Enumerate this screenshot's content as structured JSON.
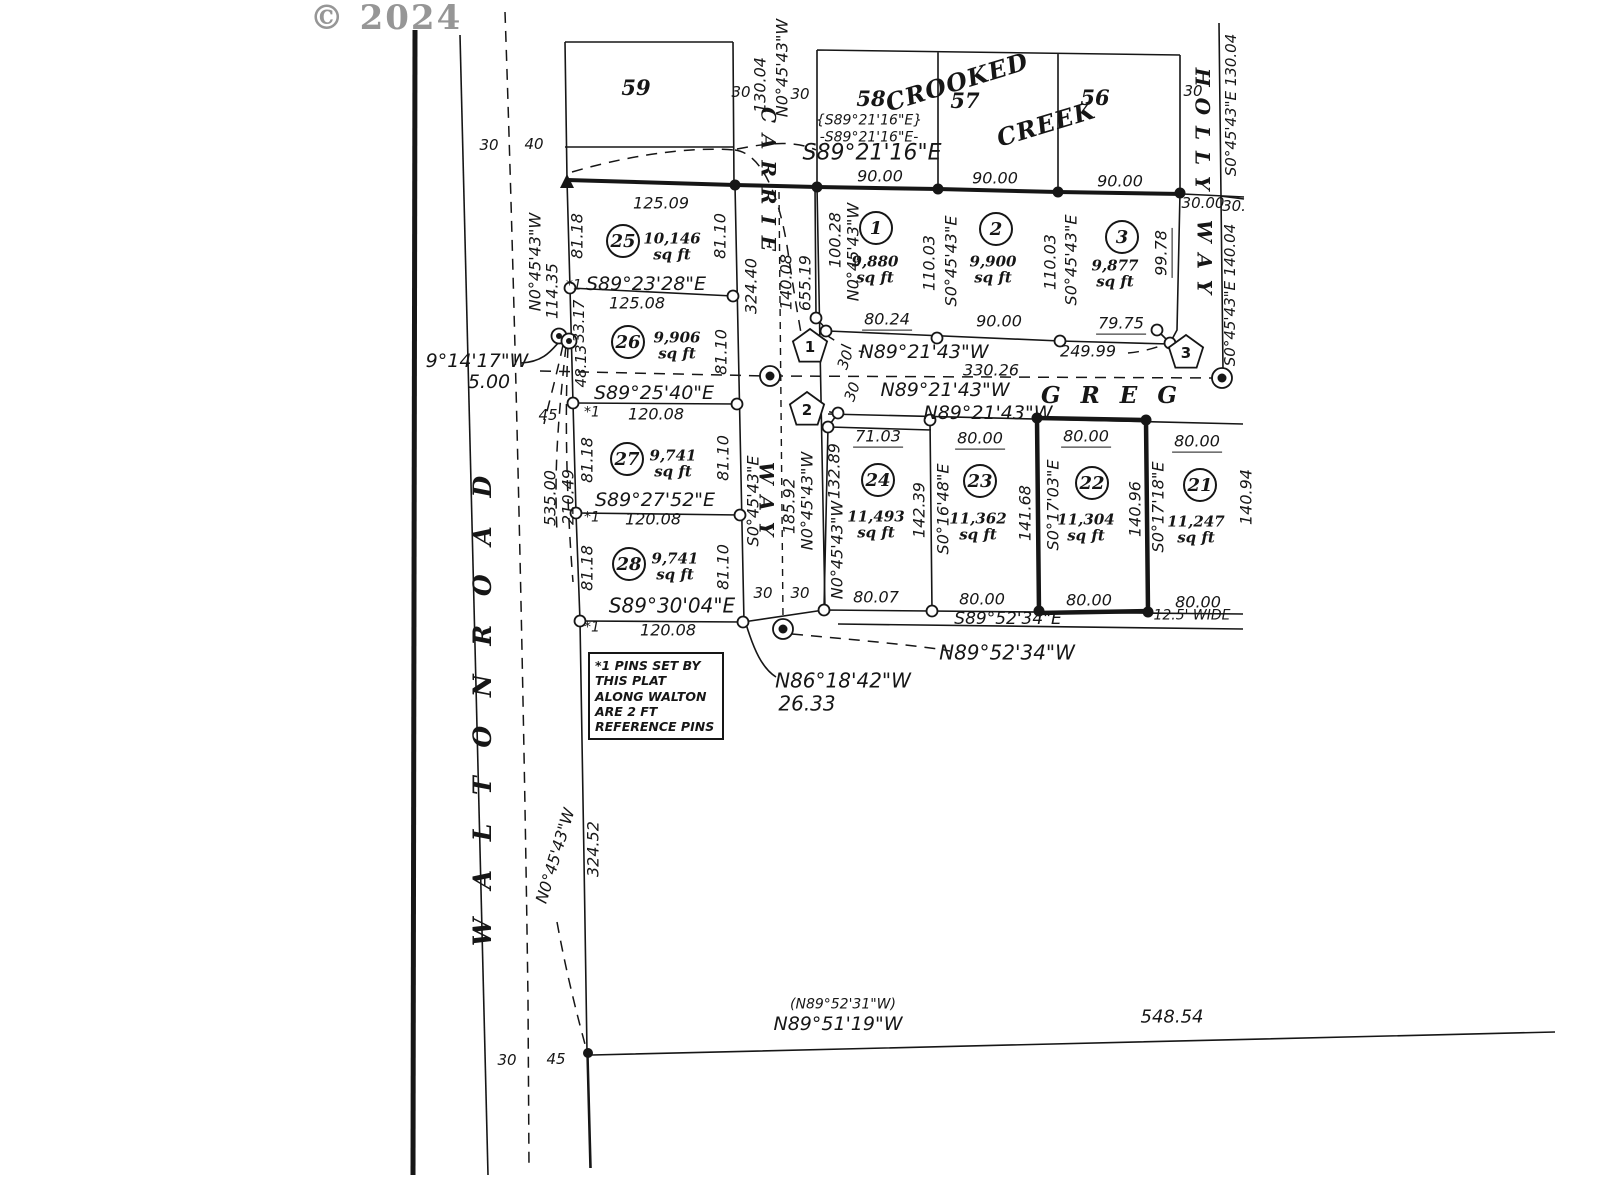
{
  "watermark": "© 2024",
  "colors": {
    "ink": "#161616",
    "background": "#ffffff",
    "watermark_gray": "#969696"
  },
  "note_box": {
    "lines": [
      "*1 PINS SET BY",
      "THIS PLAT",
      "ALONG WALTON",
      "ARE 2 FT",
      "REFERENCE PINS"
    ]
  },
  "streets": {
    "walton_road": "WALTON ROAD",
    "carrie_way": "CARRIE WAY",
    "greg": "GREG",
    "holly_way": "HOLLY WAY",
    "creek": "CROOKED CREEK"
  },
  "lots": [
    {
      "number": "1",
      "area": "9,880 sq ft"
    },
    {
      "number": "2",
      "area": "9,900 sq ft"
    },
    {
      "number": "3",
      "area": "9,877 sq ft"
    },
    {
      "number": "21",
      "area": "11,247 sq ft"
    },
    {
      "number": "22",
      "area": "11,304 sq ft",
      "highlighted": true
    },
    {
      "number": "23",
      "area": "11,362 sq ft"
    },
    {
      "number": "24",
      "area": "11,493 sq ft"
    },
    {
      "number": "25",
      "area": "10,146 sq ft"
    },
    {
      "number": "26",
      "area": "9,906 sq ft"
    },
    {
      "number": "27",
      "area": "9,741 sq ft"
    },
    {
      "number": "28",
      "area": "9,741 sq ft"
    }
  ],
  "adjacent_lots": [
    "59",
    "58",
    "57",
    "56"
  ],
  "labels": [
    {
      "n": "copyright-watermark",
      "t": "© 2024",
      "x": 386,
      "y": 19,
      "c": "wm"
    },
    {
      "t": "30",
      "x": 489,
      "y": 146,
      "c": "sm"
    },
    {
      "t": "40",
      "x": 534,
      "y": 145,
      "c": "sm"
    },
    {
      "n": "lot-59-number",
      "t": "59",
      "x": 636,
      "y": 88,
      "c": "adj"
    },
    {
      "n": "lot-58-number",
      "t": "58",
      "x": 871,
      "y": 99,
      "c": "adj"
    },
    {
      "n": "lot-57-number",
      "t": "57",
      "x": 965,
      "y": 101,
      "c": "adj"
    },
    {
      "n": "lot-56-number",
      "t": "56",
      "x": 1095,
      "y": 98,
      "c": "adj"
    },
    {
      "n": "creek-name-crooked",
      "t": "CROOKED",
      "x": 957,
      "y": 82,
      "r": -17,
      "c": "creek"
    },
    {
      "n": "creek-name-creek",
      "t": "CREEK",
      "x": 1046,
      "y": 124,
      "r": -17,
      "c": "creek"
    },
    {
      "t": "{S89°21'16\"E}",
      "x": 869,
      "y": 121,
      "c": "smi"
    },
    {
      "t": "-S89°21'16\"E-",
      "x": 869,
      "y": 138,
      "c": "smi"
    },
    {
      "t": "S89°21'16\"E",
      "x": 872,
      "y": 153,
      "c": "big"
    },
    {
      "t": "125.09",
      "x": 661,
      "y": 204,
      "c": "dim"
    },
    {
      "t": "90.00",
      "x": 880,
      "y": 177,
      "c": "dim"
    },
    {
      "t": "90.00",
      "x": 995,
      "y": 179,
      "c": "dim"
    },
    {
      "t": "90.00",
      "x": 1120,
      "y": 182,
      "c": "dim"
    },
    {
      "t": "130.04",
      "x": 761,
      "y": 85,
      "r": -90,
      "c": "dim"
    },
    {
      "t": "N0°45'43\"W",
      "x": 783,
      "y": 68,
      "r": -90,
      "c": "dim"
    },
    {
      "t": "30",
      "x": 741,
      "y": 93,
      "c": "sm"
    },
    {
      "t": "30",
      "x": 800,
      "y": 95,
      "c": "sm"
    },
    {
      "n": "street-carrie",
      "t": "C A R R I E",
      "x": 768,
      "y": 180,
      "r": 90,
      "c": "street"
    },
    {
      "n": "street-carrie-way",
      "t": "W A Y",
      "x": 766,
      "y": 500,
      "r": 90,
      "c": "street"
    },
    {
      "n": "street-holly",
      "t": "H O L L Y",
      "x": 1202,
      "y": 130,
      "r": 90,
      "c": "street"
    },
    {
      "n": "street-holly-way",
      "t": "W A Y",
      "x": 1204,
      "y": 258,
      "r": 90,
      "c": "street"
    },
    {
      "t": "30",
      "x": 1193,
      "y": 92,
      "c": "sm"
    },
    {
      "t": "S0°45'43\"E  130.04",
      "x": 1232,
      "y": 105,
      "r": -90,
      "c": "dim15"
    },
    {
      "t": "30.00",
      "x": 1203,
      "y": 204,
      "c": "dim15"
    },
    {
      "t": "30.",
      "x": 1234,
      "y": 207,
      "c": "dim15"
    },
    {
      "t": "S0°45'43\"E  140.04",
      "x": 1231,
      "y": 295,
      "r": -90,
      "c": "dim15"
    },
    {
      "t": "324.40",
      "x": 752,
      "y": 286,
      "r": -90,
      "c": "dim"
    },
    {
      "t": "140.08",
      "x": 787,
      "y": 282,
      "r": -90,
      "c": "dim"
    },
    {
      "t": "655.19",
      "x": 806,
      "y": 283,
      "r": -90,
      "c": "dim"
    },
    {
      "n": "lot-1-number",
      "t": "1",
      "x": 876,
      "y": 228,
      "c": "lotnum"
    },
    {
      "n": "lot-2-number",
      "t": "2",
      "x": 996,
      "y": 229,
      "c": "lotnum"
    },
    {
      "n": "lot-3-number",
      "t": "3",
      "x": 1122,
      "y": 237,
      "c": "lotnum"
    },
    {
      "n": "lot-1-area",
      "t": "9,880\nsq ft",
      "x": 875,
      "y": 270,
      "c": "sqft"
    },
    {
      "n": "lot-2-area",
      "t": "9,900\nsq ft",
      "x": 993,
      "y": 270,
      "c": "sqft"
    },
    {
      "n": "lot-3-area",
      "t": "9,877\nsq ft",
      "x": 1115,
      "y": 274,
      "c": "sqft"
    },
    {
      "t": "100.28",
      "x": 836,
      "y": 240,
      "r": -90,
      "c": "dim"
    },
    {
      "t": "N0°45'43\"W",
      "x": 854,
      "y": 252,
      "r": -90,
      "c": "dim"
    },
    {
      "t": "110.03",
      "x": 930,
      "y": 263,
      "r": -90,
      "c": "dim"
    },
    {
      "t": "S0°45'43\"E",
      "x": 952,
      "y": 261,
      "r": -90,
      "c": "dim"
    },
    {
      "t": "110.03",
      "x": 1051,
      "y": 262,
      "r": -90,
      "c": "dim"
    },
    {
      "t": "S0°45'43\"E",
      "x": 1072,
      "y": 260,
      "r": -90,
      "c": "dim"
    },
    {
      "t": "99.78",
      "x": 1163,
      "y": 253,
      "r": -90,
      "c": "dimu"
    },
    {
      "t": "80.24",
      "x": 887,
      "y": 321,
      "c": "dimu"
    },
    {
      "t": "90.00",
      "x": 999,
      "y": 322,
      "c": "dim"
    },
    {
      "t": "79.75",
      "x": 1121,
      "y": 325,
      "c": "dimu"
    },
    {
      "t": "N89°21'43\"W",
      "x": 924,
      "y": 353,
      "c": "brg"
    },
    {
      "t": "249.99",
      "x": 1088,
      "y": 352,
      "c": "dim"
    },
    {
      "t": "330.26",
      "x": 991,
      "y": 371,
      "c": "dim"
    },
    {
      "t": "N89°21'43\"W",
      "x": 945,
      "y": 391,
      "c": "brg"
    },
    {
      "n": "street-greg",
      "t": "G R E G",
      "x": 1112,
      "y": 396,
      "c": "greg"
    },
    {
      "t": "N89°21'43\"W",
      "x": 988,
      "y": 414,
      "c": "brg"
    },
    {
      "n": "curve-marker-1",
      "t": "1",
      "x": 810,
      "y": 348,
      "c": "pent"
    },
    {
      "n": "curve-marker-2",
      "t": "2",
      "x": 807,
      "y": 411,
      "c": "pent"
    },
    {
      "n": "curve-marker-3",
      "t": "3",
      "x": 1186,
      "y": 354,
      "c": "pent"
    },
    {
      "t": "30",
      "x": 846,
      "y": 360,
      "r": -70,
      "c": "sm"
    },
    {
      "t": "30",
      "x": 853,
      "y": 392,
      "r": -70,
      "c": "sm"
    },
    {
      "t": "71.03",
      "x": 878,
      "y": 438,
      "c": "dimu"
    },
    {
      "t": "80.00",
      "x": 980,
      "y": 440,
      "c": "dimu"
    },
    {
      "t": "80.00",
      "x": 1086,
      "y": 438,
      "c": "dimu"
    },
    {
      "t": "80.00",
      "x": 1197,
      "y": 443,
      "c": "dimu"
    },
    {
      "t": "132.89",
      "x": 835,
      "y": 471,
      "r": -90,
      "c": "dim"
    },
    {
      "t": "N0°45'43\"W",
      "x": 838,
      "y": 550,
      "r": -90,
      "c": "dim"
    },
    {
      "t": "142.39",
      "x": 920,
      "y": 510,
      "r": -90,
      "c": "dim"
    },
    {
      "t": "S0°16'48\"E",
      "x": 944,
      "y": 509,
      "r": -90,
      "c": "dim"
    },
    {
      "t": "141.68",
      "x": 1026,
      "y": 513,
      "r": -90,
      "c": "dim"
    },
    {
      "t": "S0°17'03\"E",
      "x": 1054,
      "y": 505,
      "r": -90,
      "c": "dim"
    },
    {
      "t": "140.96",
      "x": 1136,
      "y": 509,
      "r": -90,
      "c": "dim"
    },
    {
      "t": "S0°17'18\"E",
      "x": 1159,
      "y": 507,
      "r": -90,
      "c": "dim"
    },
    {
      "n": "lot-24-number",
      "t": "24",
      "x": 878,
      "y": 480,
      "c": "lotnum"
    },
    {
      "n": "lot-23-number",
      "t": "23",
      "x": 980,
      "y": 481,
      "c": "lotnum"
    },
    {
      "n": "lot-22-number",
      "t": "22",
      "x": 1092,
      "y": 483,
      "c": "lotnum"
    },
    {
      "n": "lot-21-number",
      "t": "21",
      "x": 1200,
      "y": 485,
      "c": "lotnum"
    },
    {
      "n": "lot-24-area",
      "t": "11,493\nsq ft",
      "x": 876,
      "y": 525,
      "c": "sqft"
    },
    {
      "n": "lot-23-area",
      "t": "11,362\nsq ft",
      "x": 978,
      "y": 527,
      "c": "sqft"
    },
    {
      "n": "lot-22-area",
      "t": "11,304\nsq ft",
      "x": 1086,
      "y": 528,
      "c": "sqft"
    },
    {
      "n": "lot-21-area",
      "t": "11,247\nsq ft",
      "x": 1196,
      "y": 530,
      "c": "sqft"
    },
    {
      "t": "80.07",
      "x": 876,
      "y": 598,
      "c": "dim"
    },
    {
      "t": "80.00",
      "x": 982,
      "y": 600,
      "c": "dim"
    },
    {
      "t": "80.00",
      "x": 1089,
      "y": 601,
      "c": "dim"
    },
    {
      "t": "80.00",
      "x": 1198,
      "y": 603,
      "c": "dim"
    },
    {
      "t": "S89°52'34\"E",
      "x": 1008,
      "y": 620,
      "c": "brg17"
    },
    {
      "t": "12.5'  WIDE",
      "x": 1192,
      "y": 616,
      "c": "smi"
    },
    {
      "t": "N89°52'34\"W",
      "x": 1007,
      "y": 653,
      "c": "big2"
    },
    {
      "t": "140.94",
      "x": 1247,
      "y": 497,
      "r": -90,
      "c": "dim"
    },
    {
      "t": "S0°45'43\"E",
      "x": 754,
      "y": 501,
      "r": -90,
      "c": "dim"
    },
    {
      "t": "185.92",
      "x": 790,
      "y": 506,
      "r": -90,
      "c": "dim"
    },
    {
      "t": "N0°45'43\"W",
      "x": 808,
      "y": 501,
      "r": -90,
      "c": "dim"
    },
    {
      "t": "30",
      "x": 763,
      "y": 594,
      "c": "sm"
    },
    {
      "t": "30",
      "x": 800,
      "y": 594,
      "c": "sm"
    },
    {
      "n": "lot-25-number",
      "t": "25",
      "x": 623,
      "y": 241,
      "c": "lotnum"
    },
    {
      "n": "lot-26-number",
      "t": "26",
      "x": 628,
      "y": 342,
      "c": "lotnum"
    },
    {
      "n": "lot-27-number",
      "t": "27",
      "x": 627,
      "y": 459,
      "c": "lotnum"
    },
    {
      "n": "lot-28-number",
      "t": "28",
      "x": 629,
      "y": 564,
      "c": "lotnum"
    },
    {
      "n": "lot-25-area",
      "t": "10,146\nsq ft",
      "x": 672,
      "y": 247,
      "c": "sqft"
    },
    {
      "n": "lot-26-area",
      "t": "9,906\nsq ft",
      "x": 677,
      "y": 346,
      "c": "sqft"
    },
    {
      "n": "lot-27-area",
      "t": "9,741\nsq ft",
      "x": 673,
      "y": 464,
      "c": "sqft"
    },
    {
      "n": "lot-28-area",
      "t": "9,741\nsq ft",
      "x": 675,
      "y": 567,
      "c": "sqft"
    },
    {
      "t": "81.18",
      "x": 578,
      "y": 236,
      "r": -90,
      "c": "dim"
    },
    {
      "t": "81.10",
      "x": 721,
      "y": 236,
      "r": -90,
      "c": "dim"
    },
    {
      "t": "S89°23'28\"E",
      "x": 646,
      "y": 285,
      "c": "brg"
    },
    {
      "t": "*1",
      "x": 574,
      "y": 286,
      "c": "smi"
    },
    {
      "t": "125.08",
      "x": 637,
      "y": 304,
      "c": "dim"
    },
    {
      "t": "33.17",
      "x": 580,
      "y": 321,
      "r": -90,
      "c": "dim15"
    },
    {
      "t": "48.13",
      "x": 582,
      "y": 366,
      "r": -90,
      "c": "dim15"
    },
    {
      "t": "81.10",
      "x": 722,
      "y": 352,
      "r": -90,
      "c": "dim"
    },
    {
      "t": "S89°25'40\"E",
      "x": 654,
      "y": 394,
      "c": "brg"
    },
    {
      "t": "*1",
      "x": 592,
      "y": 413,
      "c": "smi"
    },
    {
      "t": "120.08",
      "x": 656,
      "y": 415,
      "c": "dim"
    },
    {
      "t": "81.18",
      "x": 588,
      "y": 460,
      "r": -90,
      "c": "dim"
    },
    {
      "t": "81.10",
      "x": 724,
      "y": 458,
      "r": -90,
      "c": "dim"
    },
    {
      "t": "535.00",
      "x": 551,
      "y": 498,
      "r": -90,
      "c": "dim"
    },
    {
      "t": "210.49",
      "x": 569,
      "y": 497,
      "r": -90,
      "c": "dim"
    },
    {
      "t": "S89°27'52\"E",
      "x": 655,
      "y": 501,
      "c": "brg"
    },
    {
      "t": "*1",
      "x": 592,
      "y": 518,
      "c": "smi"
    },
    {
      "t": "120.08",
      "x": 653,
      "y": 520,
      "c": "dim"
    },
    {
      "t": "81.18",
      "x": 588,
      "y": 568,
      "r": -90,
      "c": "dim"
    },
    {
      "t": "81.10",
      "x": 724,
      "y": 567,
      "r": -90,
      "c": "dim"
    },
    {
      "t": "S89°30'04\"E",
      "x": 672,
      "y": 606,
      "c": "big2"
    },
    {
      "t": "*1",
      "x": 592,
      "y": 628,
      "c": "smi"
    },
    {
      "t": "120.08",
      "x": 668,
      "y": 631,
      "c": "dim"
    },
    {
      "t": "114.35",
      "x": 553,
      "y": 291,
      "r": -90,
      "c": "dim"
    },
    {
      "t": "N0°45'43\"W",
      "x": 536,
      "y": 262,
      "r": -90,
      "c": "dim"
    },
    {
      "t": "9°14'17\"W",
      "x": 477,
      "y": 362,
      "c": "brg"
    },
    {
      "t": "5.00",
      "x": 489,
      "y": 383,
      "c": "brg"
    },
    {
      "t": "45",
      "x": 548,
      "y": 416,
      "c": "sm"
    },
    {
      "n": "street-walton-road",
      "t": "W A L T O N    R O A D",
      "x": 483,
      "y": 706,
      "r": -90,
      "c": "walton"
    },
    {
      "t": "N0°45'43\"W",
      "x": 556,
      "y": 856,
      "r": -73,
      "c": "dim"
    },
    {
      "t": "324.52",
      "x": 594,
      "y": 849,
      "r": -90,
      "c": "dim"
    },
    {
      "t": "N86°18'42\"W",
      "x": 843,
      "y": 681,
      "c": "big2"
    },
    {
      "t": "26.33",
      "x": 807,
      "y": 704,
      "c": "big2"
    },
    {
      "t": "30",
      "x": 507,
      "y": 1061,
      "c": "sm"
    },
    {
      "t": "45",
      "x": 556,
      "y": 1060,
      "c": "sm"
    },
    {
      "t": "(N89°52'31\"W)",
      "x": 843,
      "y": 1005,
      "c": "smi"
    },
    {
      "t": "N89°51'19\"W",
      "x": 838,
      "y": 1025,
      "c": "brg"
    },
    {
      "t": "548.54",
      "x": 1172,
      "y": 1018,
      "c": "dim18"
    }
  ]
}
